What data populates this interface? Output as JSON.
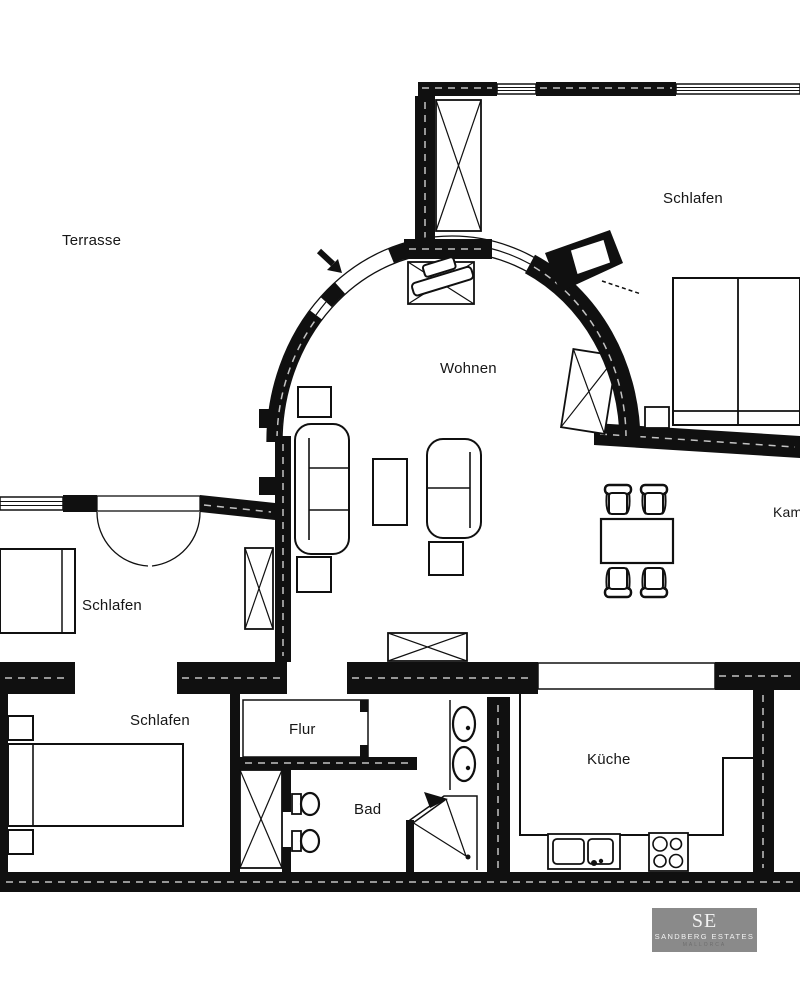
{
  "plan": {
    "labels": {
      "terrasse": "Terrasse",
      "schlafen_top": "Schlafen",
      "wohnen": "Wohnen",
      "schlafen_mid": "Schlafen",
      "schlafen_bottom": "Schlafen",
      "flur": "Flur",
      "bad": "Bad",
      "kueche": "Küche",
      "kamin": "Kamin"
    },
    "colors": {
      "wall": "#101010",
      "paper": "#ffffff",
      "logo_bg": "#8a8a8a",
      "logo_fg": "#f2f2f2",
      "logo_sub": "#6d6d6d"
    }
  },
  "logo": {
    "monogram": "SE",
    "name": "SANDBERG ESTATES",
    "location": "MALLORCA"
  }
}
